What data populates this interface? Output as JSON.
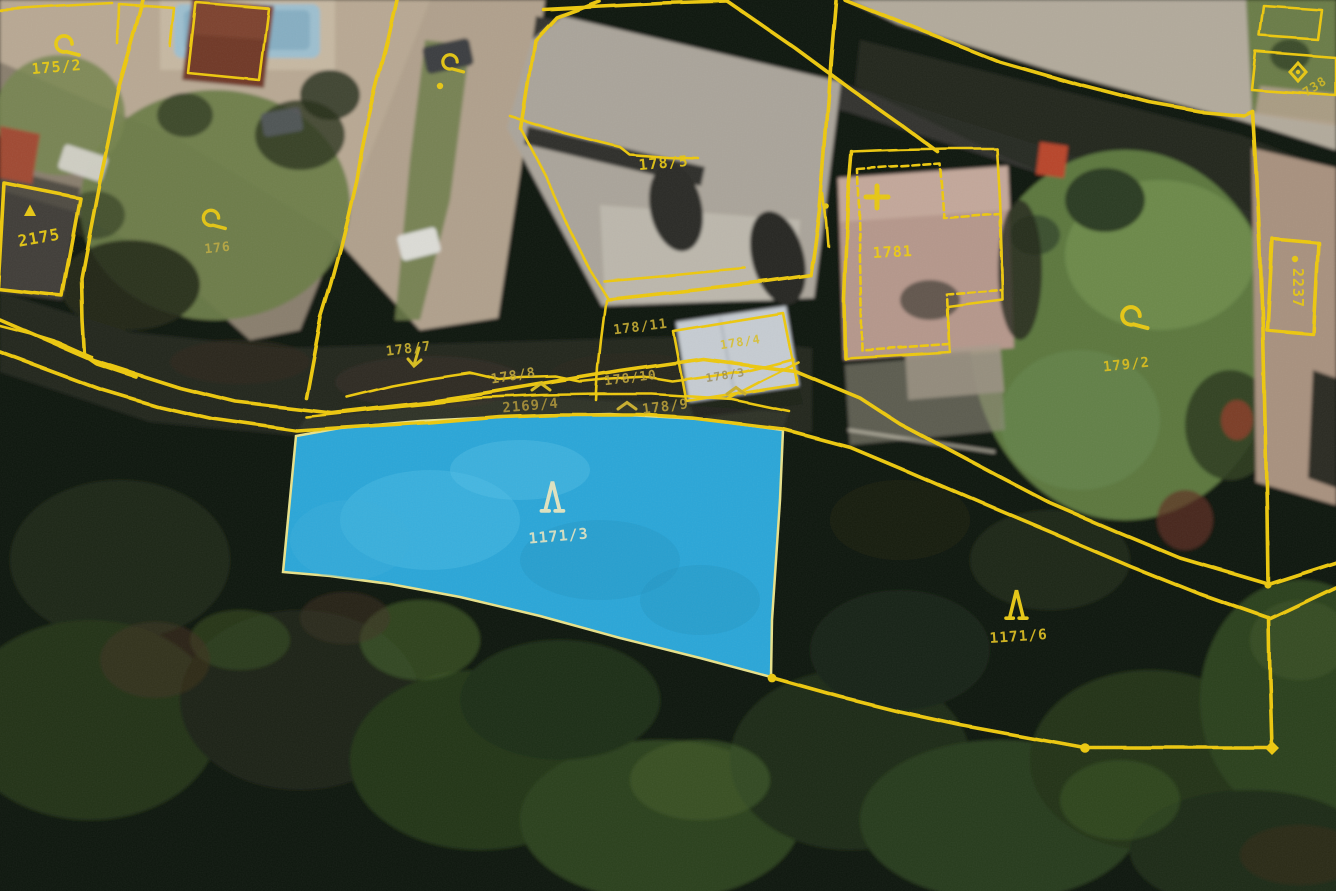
{
  "map": {
    "type": "cadastral-aerial-overlay",
    "highlighted_parcel": "1171/3",
    "highlight_fill": "#2aa6d8",
    "boundary_color": "#edc80e",
    "labels": [
      {
        "text": "175/2",
        "x": 57,
        "y": 72,
        "rot": -5,
        "size": 15,
        "color": "#e9cb12",
        "opacity": 0.95
      },
      {
        "text": "2175",
        "x": 40,
        "y": 243,
        "rot": -10,
        "size": 16,
        "color": "#e9cb12",
        "opacity": 0.95
      },
      {
        "text": "176",
        "x": 218,
        "y": 252,
        "rot": -6,
        "size": 13,
        "color": "#c6b040",
        "opacity": 0.8
      },
      {
        "text": "178/5",
        "x": 664,
        "y": 168,
        "rot": -5,
        "size": 15,
        "color": "#e5c513",
        "opacity": 0.95
      },
      {
        "text": "178/11",
        "x": 641,
        "y": 331,
        "rot": -7,
        "size": 13.5,
        "color": "#c8ad30",
        "opacity": 0.9
      },
      {
        "text": "178/4",
        "x": 741,
        "y": 346,
        "rot": -9,
        "size": 12,
        "color": "#d8bf2c",
        "opacity": 0.9
      },
      {
        "text": "178/3",
        "x": 726,
        "y": 379,
        "rot": -9,
        "size": 11.5,
        "color": "#93854e",
        "opacity": 0.75
      },
      {
        "text": "1781",
        "x": 893,
        "y": 257,
        "rot": -3,
        "size": 15,
        "color": "#edcb11",
        "opacity": 0.95
      },
      {
        "text": "178/7",
        "x": 409,
        "y": 353,
        "rot": -7,
        "size": 13.5,
        "color": "#cfb42c",
        "opacity": 0.9
      },
      {
        "text": "178/8",
        "x": 514,
        "y": 380,
        "rot": -9,
        "size": 13.5,
        "color": "#c2a83c",
        "opacity": 0.9
      },
      {
        "text": "178/10",
        "x": 631,
        "y": 382,
        "rot": -7,
        "size": 13,
        "color": "#bfa53c",
        "opacity": 0.9
      },
      {
        "text": "2169/4",
        "x": 531,
        "y": 410,
        "rot": -5,
        "size": 14,
        "color": "#ab9236",
        "opacity": 0.9
      },
      {
        "text": "178/9",
        "x": 666,
        "y": 411,
        "rot": -7,
        "size": 14,
        "color": "#b89e34",
        "opacity": 0.9
      },
      {
        "text": "1171/3",
        "x": 559,
        "y": 541,
        "rot": -5,
        "size": 15,
        "color": "#dde2c2",
        "opacity": 0.95
      },
      {
        "text": "1171/6",
        "x": 1019,
        "y": 641,
        "rot": -4,
        "size": 14.5,
        "color": "#d9ba1e",
        "opacity": 0.95
      },
      {
        "text": "179/2",
        "x": 1127,
        "y": 369,
        "rot": -6,
        "size": 14,
        "color": "#d9bd1c",
        "opacity": 0.95
      },
      {
        "text": "2237",
        "x": 1293,
        "y": 288,
        "rot": 90,
        "size": 15,
        "color": "#e6c614",
        "opacity": 0.95
      },
      {
        "text": "738",
        "x": 1317,
        "y": 90,
        "rot": -33,
        "size": 12.5,
        "color": "#d8bd1e",
        "opacity": 0.85
      }
    ],
    "symbols": [
      {
        "type": "curl",
        "x": 64,
        "y": 44,
        "s": 1,
        "color": "#e9cb12"
      },
      {
        "type": "curl",
        "x": 211,
        "y": 218,
        "s": 0.95,
        "color": "#e2c414"
      },
      {
        "type": "curl",
        "x": 450,
        "y": 62,
        "s": 0.9,
        "color": "#e2c414"
      },
      {
        "type": "curl",
        "x": 1131,
        "y": 316,
        "s": 1.1,
        "color": "#e6c714"
      },
      {
        "type": "tree",
        "x": 553,
        "y": 496,
        "s": 1.1,
        "color": "#dfe3c0"
      },
      {
        "type": "tree",
        "x": 1017,
        "y": 604,
        "s": 1.05,
        "color": "#e7c714"
      },
      {
        "type": "cross",
        "x": 877,
        "y": 197,
        "s": 1,
        "color": "#e7c714"
      },
      {
        "type": "diamond",
        "x": 1298,
        "y": 72,
        "s": 1,
        "color": "#e7c714"
      },
      {
        "type": "dot",
        "x": 1295,
        "y": 259,
        "s": 0.8,
        "color": "#e7c714"
      },
      {
        "type": "dot",
        "x": 440,
        "y": 86,
        "s": 0.8,
        "color": "#e7c714"
      },
      {
        "type": "dot",
        "x": 826,
        "y": 206,
        "s": 0.7,
        "color": "#e7c714"
      },
      {
        "type": "dot",
        "x": 772,
        "y": 678,
        "s": 1.1,
        "color": "#edc80e"
      },
      {
        "type": "dot",
        "x": 1085,
        "y": 748,
        "s": 1.2,
        "color": "#edc80e"
      },
      {
        "type": "dot",
        "x": 1268,
        "y": 585,
        "s": 0.9,
        "color": "#edc80e"
      },
      {
        "type": "vdiamond",
        "x": 1272,
        "y": 748,
        "s": 1,
        "color": "#edc80e"
      },
      {
        "type": "triangle",
        "x": 30,
        "y": 211,
        "s": 1,
        "color": "#e7c714"
      },
      {
        "type": "arrow",
        "x": 416,
        "y": 358,
        "s": 1,
        "color": "#d8bd1e"
      },
      {
        "type": "tick",
        "x": 541,
        "y": 387,
        "s": 1,
        "color": "#d8bd1e"
      },
      {
        "type": "tick",
        "x": 627,
        "y": 406,
        "s": 1,
        "color": "#c9ae2e"
      },
      {
        "type": "tick",
        "x": 736,
        "y": 391,
        "s": 1,
        "color": "#c9ae2e"
      }
    ]
  }
}
